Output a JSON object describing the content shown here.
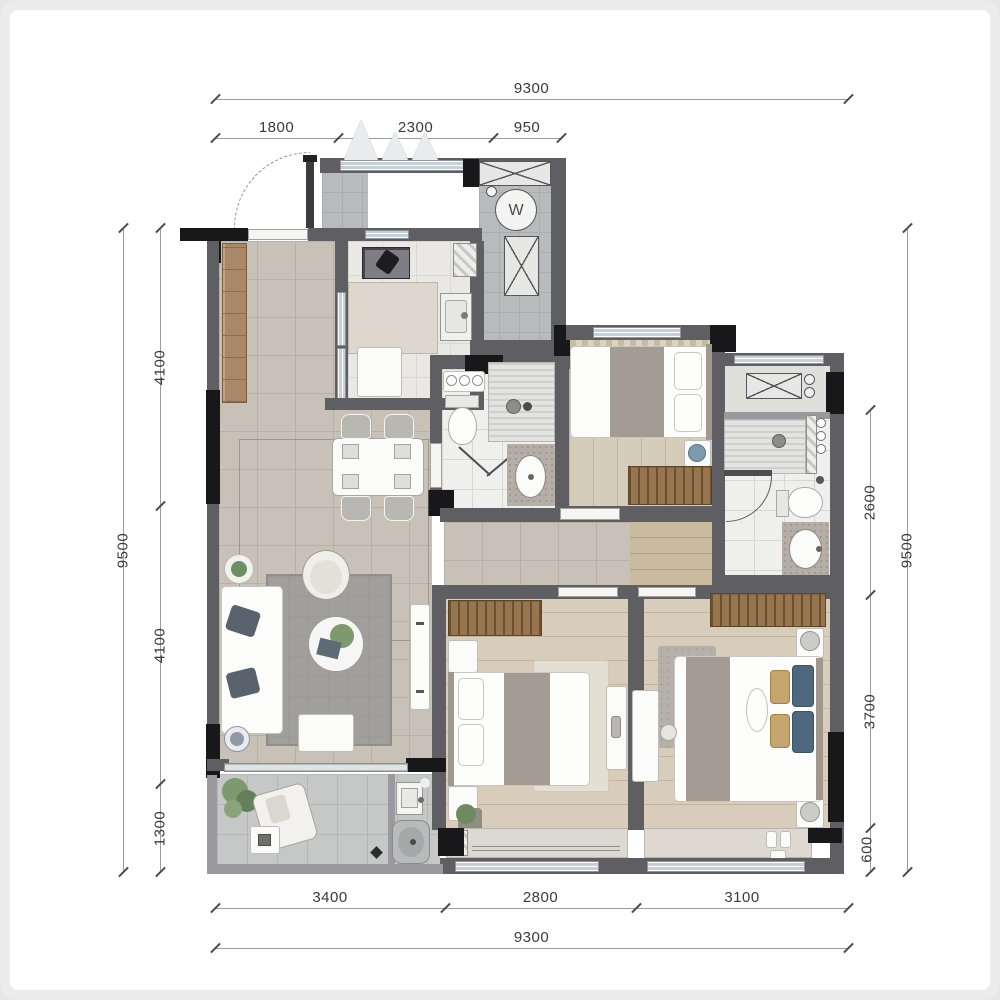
{
  "plan": {
    "title": "apartment-floor-plan",
    "washer_symbol": "W",
    "dimensions": {
      "top": {
        "total": "9300",
        "segments": [
          "1800",
          "2300",
          "950"
        ]
      },
      "bottom": {
        "total": "9300",
        "segments": [
          "3400",
          "2800",
          "3100"
        ]
      },
      "left": {
        "total": "9500",
        "segments": [
          "4100",
          "4100",
          "1300"
        ]
      },
      "right": {
        "total": "9500",
        "segments": [
          "2600",
          "3700",
          "600"
        ]
      }
    },
    "palette": {
      "wall": "#5e5e63",
      "column": "#18181a",
      "floor_tile": "#c8c1b7",
      "floor_wood": "#d6ccba",
      "glazing": "#c7d0d6",
      "wardrobe": "#97754f",
      "dimension_text": "#3a3a3a"
    }
  }
}
